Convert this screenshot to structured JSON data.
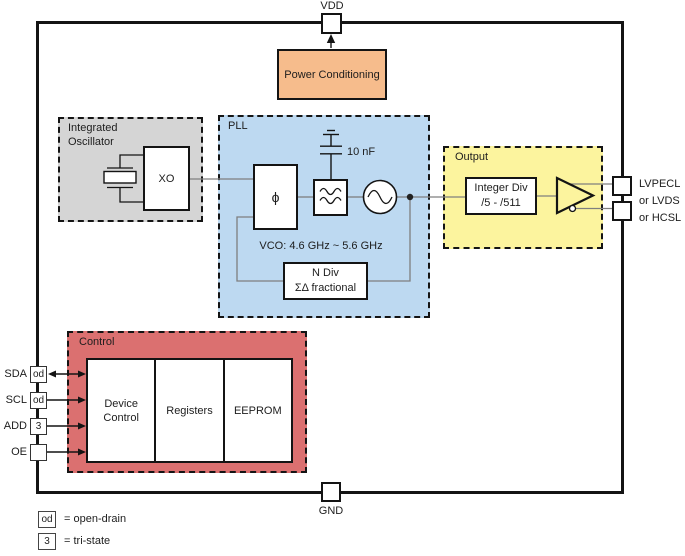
{
  "colors": {
    "oscillator_fill": "#D5D5D5",
    "pll_fill": "#BDD9F1",
    "output_fill": "#FCF49E",
    "control_fill": "#DB7070",
    "power_fill": "#F6BC8C",
    "wire": "#7f7f7f",
    "line": "#141414"
  },
  "top": {
    "vdd_label": "VDD",
    "power_box": "Power Conditioning"
  },
  "bottom": {
    "gnd_label": "GND"
  },
  "oscillator": {
    "label": "Integrated Oscillator",
    "xo": "XO"
  },
  "pll": {
    "label": "PLL",
    "phase_detector": "ϕ",
    "cap_label": "10 nF",
    "vco_range": "VCO: 4.6 GHz ~ 5.6 GHz",
    "ndiv_line1": "N Div",
    "ndiv_line2": "ΣΔ fractional"
  },
  "output": {
    "label": "Output",
    "divider_line1": "Integer Div",
    "divider_line2": "/5 - /511",
    "signal_lines": [
      "LVPECL",
      "or LVDS",
      "or HCSL"
    ]
  },
  "control": {
    "label": "Control",
    "blocks": [
      "Device Control",
      "Registers",
      "EEPROM"
    ]
  },
  "pins": [
    {
      "name": "SDA",
      "badge": "od"
    },
    {
      "name": "SCL",
      "badge": "od"
    },
    {
      "name": "ADD",
      "badge": "3"
    },
    {
      "name": "OE",
      "badge": ""
    }
  ],
  "legend": [
    {
      "badge": "od",
      "text": "= open-drain"
    },
    {
      "badge": "3",
      "text": "= tri-state"
    }
  ]
}
